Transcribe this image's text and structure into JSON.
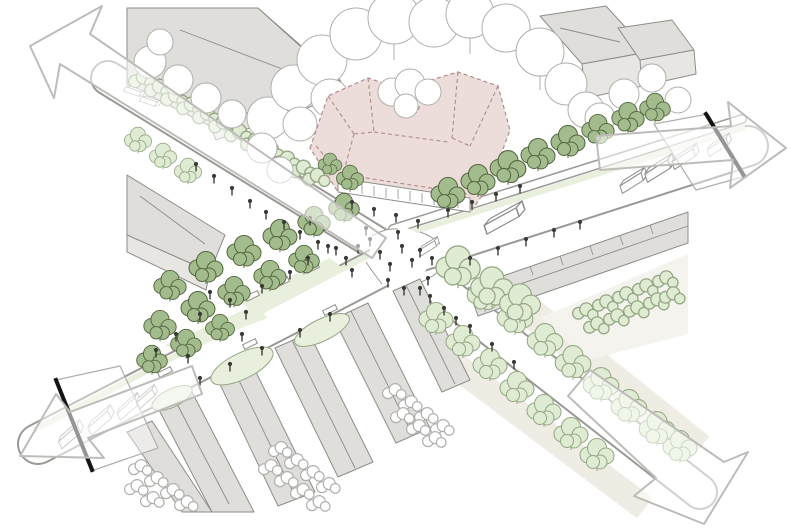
{
  "figure": {
    "kind": "axonometric urban design sketch",
    "subject": "street intersection redesign with tree-lined avenues, pedestrian promenade, pocket park and a proposed corner building shown as pink dashed massing",
    "proposed_building": "pink dashed massing with faceted roof and ground-floor storefronts",
    "arrows": [
      {
        "id": "top-left",
        "direction": "up-left"
      },
      {
        "id": "right",
        "direction": "right"
      },
      {
        "id": "bottom-left",
        "direction": "down-left"
      },
      {
        "id": "bottom-right",
        "direction": "down-right"
      }
    ],
    "section_cuts": [
      "left street end",
      "right street end"
    ],
    "elements": [
      "existing buildings",
      "housing rows",
      "dark green street trees",
      "light green street trees",
      "white park trees",
      "hedges",
      "lawns",
      "pedestrians",
      "buses and trucks at section cuts",
      "zebra crossings"
    ]
  },
  "colors": {
    "paper": "#ffffff",
    "outline": "#8e8d8a",
    "outline_soft": "#b0afac",
    "road_edge": "#9a9995",
    "building_wall": "#e7e6e3",
    "building_roof": "#dfdeda",
    "pink_roof": "#ecdcda",
    "pink_wall": "#f3e7e5",
    "pink_line": "#b18c8a",
    "tree_dark": "#a3bc8d",
    "tree_dark_outline": "#53653e",
    "tree_light": "#dfebd2",
    "tree_light_outline": "#94a884",
    "lawn": "#e9efdd",
    "beige": "#ece9df",
    "section_cut": "#141414",
    "arrow_stroke": "#bdbcb8",
    "figure_dark": "#3a3a37"
  }
}
